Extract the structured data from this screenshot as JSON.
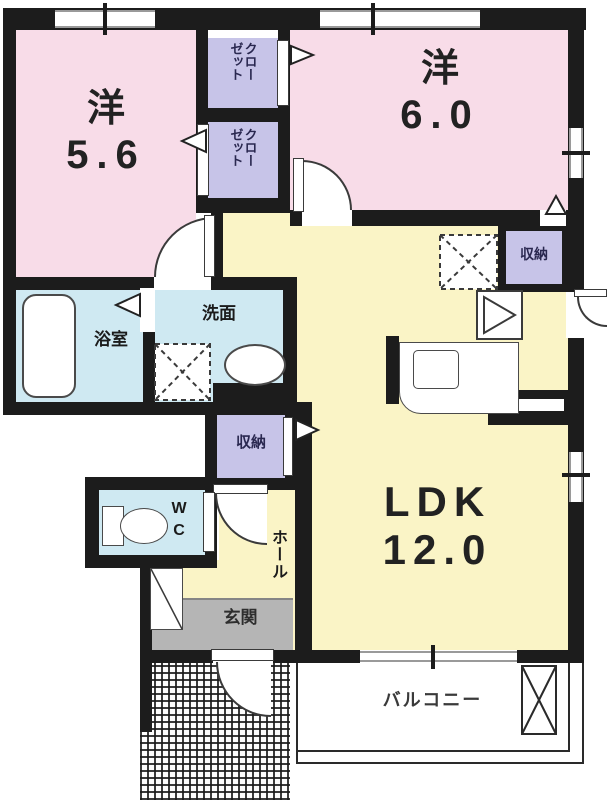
{
  "rooms": {
    "bedroom_a": {
      "type_label": "洋",
      "size_label": "5.6"
    },
    "bedroom_b": {
      "type_label": "洋",
      "size_label": "6.0"
    },
    "ldk": {
      "type_label": "LDK",
      "size_label": "12.0"
    },
    "bathroom": {
      "label": "浴室"
    },
    "washroom": {
      "label": "洗面"
    },
    "toilet": {
      "line1": "W",
      "line2": "C"
    },
    "hall": {
      "label": "ホール"
    },
    "entrance": {
      "label": "玄関"
    },
    "balcony": {
      "label": "バルコニー"
    },
    "closet_top": {
      "column_right": "クロー",
      "column_left": "ゼット"
    },
    "closet_bottom": {
      "column_right": "クロー",
      "column_left": "ゼット"
    },
    "storage_hall": {
      "label": "収納"
    },
    "storage_kitchen": {
      "label": "収納"
    }
  },
  "colors": {
    "wall": "#1c1c1c",
    "bedroom_fill": "#f8dce8",
    "living_fill": "#faf4c6",
    "wet_area_fill": "#cfe9f2",
    "closet_fill": "#c7c4e8",
    "entrance_fill": "#b5b5b5"
  }
}
